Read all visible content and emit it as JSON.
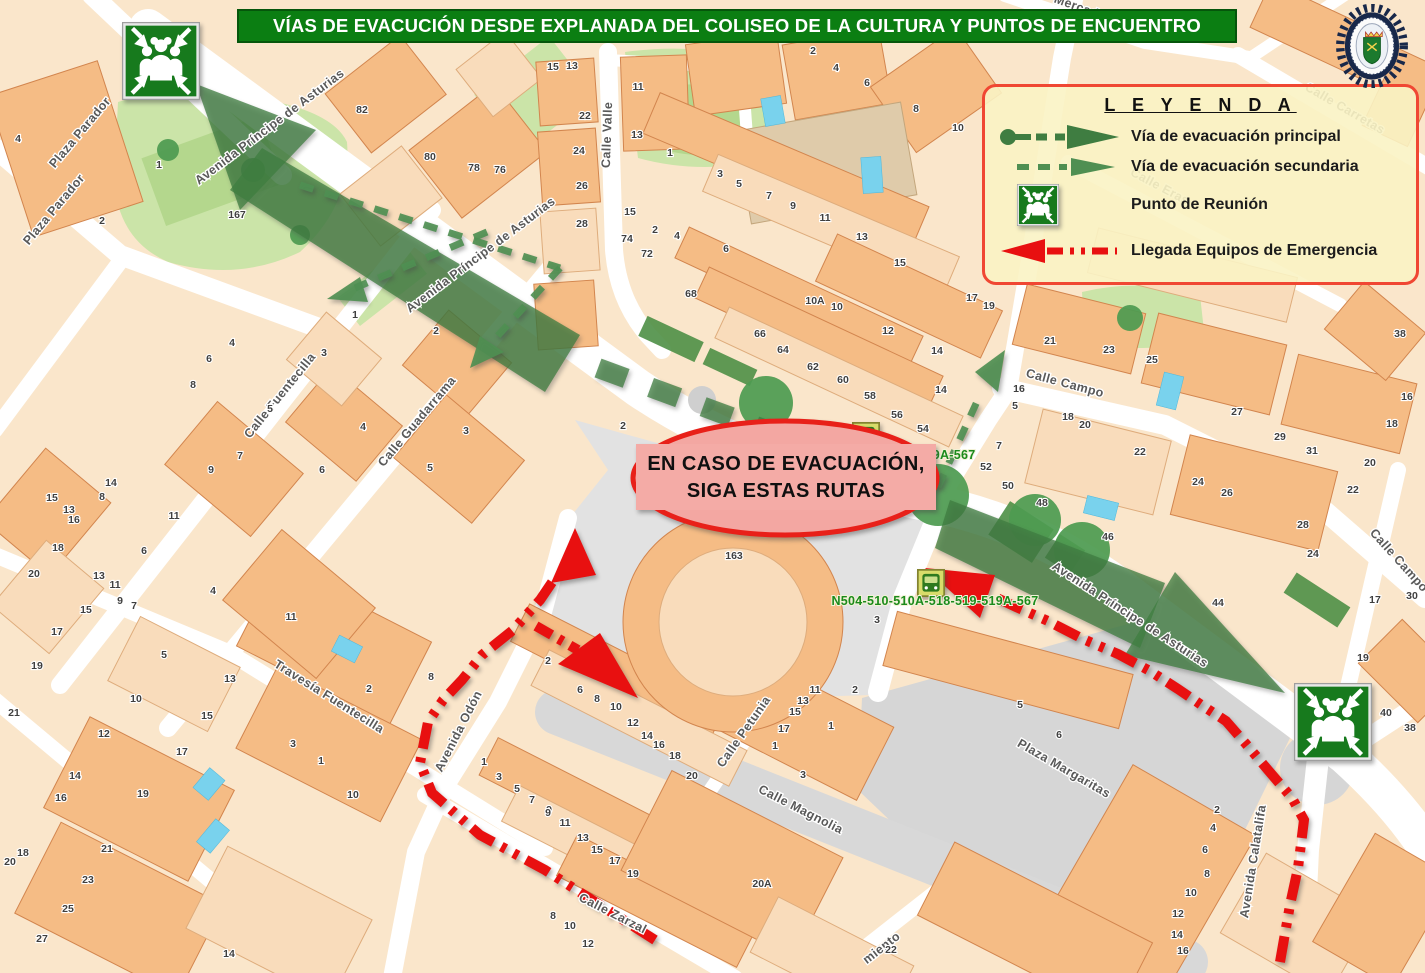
{
  "title": {
    "text": "VÍAS DE EVACUCIÓN DESDE EXPLANADA DEL COLISEO DE LA CULTURA Y PUNTOS DE ENCUENTRO"
  },
  "legend": {
    "title": "L E Y E N D A",
    "items": [
      {
        "id": "principal",
        "icon": "principal-route-arrow-icon",
        "label": "Vía de evacuación principal"
      },
      {
        "id": "secundaria",
        "icon": "secondary-route-arrow-icon",
        "label": "Vía de evacuación secundaria"
      },
      {
        "id": "reunion",
        "icon": "meeting-point-icon",
        "label": "Punto de Reunión"
      },
      {
        "id": "llegada",
        "icon": "emergency-arrival-arrow-icon",
        "label": "Llegada Equipos de Emergencia"
      }
    ]
  },
  "callout": {
    "line1": "EN CASO DE EVACUACIÓN,",
    "line2": "SIGA ESTAS RUTAS"
  },
  "badge": {
    "name": "Policía Local"
  },
  "colors": {
    "banner_green": "#0B7E12",
    "route_principal": "#3F7D41",
    "route_secondary": "#4F8F52",
    "emergency_red": "#E81010",
    "legend_border": "#F04733",
    "legend_bg": "rgba(250,243,196,0.9)"
  },
  "map": {
    "bus_stops": [
      {
        "label": "N504-510-510A-518-519-519A-567",
        "icon_x": 866,
        "icon_y": 436,
        "label_x": 872,
        "label_y": 459
      },
      {
        "label": "N504-510-510A-518-519-519A-567",
        "icon_x": 931,
        "icon_y": 583,
        "label_x": 935,
        "label_y": 605
      }
    ],
    "meeting_points": [
      {
        "x": 161,
        "y": 61
      },
      {
        "x": 1333,
        "y": 722
      }
    ],
    "streets": [
      {
        "name": "Plaza Parador",
        "x": 83,
        "y": 135,
        "angle": -50
      },
      {
        "name": "Plaza Parador",
        "x": 57,
        "y": 212,
        "angle": -50
      },
      {
        "name": "Avenida Príncipe de Asturias",
        "x": 272,
        "y": 130,
        "angle": -37
      },
      {
        "name": "Avenida Príncipe de Asturias",
        "x": 483,
        "y": 258,
        "angle": -37
      },
      {
        "name": "Avenida Príncipe de Asturias",
        "x": 1128,
        "y": 618,
        "angle": 33
      },
      {
        "name": "Calle Valle",
        "x": 611,
        "y": 135,
        "angle": -88
      },
      {
        "name": "Calle Fuentecilla",
        "x": 283,
        "y": 398,
        "angle": -51
      },
      {
        "name": "Calle Guadarrama",
        "x": 420,
        "y": 424,
        "angle": -50
      },
      {
        "name": "Travesía Fuentecilla",
        "x": 327,
        "y": 700,
        "angle": 32
      },
      {
        "name": "Avenida Odón",
        "x": 462,
        "y": 733,
        "angle": -63
      },
      {
        "name": "Calle Petunia",
        "x": 747,
        "y": 734,
        "angle": -55
      },
      {
        "name": "Calle Magnolia",
        "x": 799,
        "y": 813,
        "angle": 27
      },
      {
        "name": "Plaza Margaritas",
        "x": 1062,
        "y": 772,
        "angle": 30
      },
      {
        "name": "Calle Zarzal",
        "x": 611,
        "y": 917,
        "angle": 27
      },
      {
        "name": "Calle Campo",
        "x": 1064,
        "y": 387,
        "angle": 15
      },
      {
        "name": "Calle Campo",
        "x": 1396,
        "y": 563,
        "angle": 48
      },
      {
        "name": "Calle Carretas",
        "x": 1343,
        "y": 112,
        "angle": 30
      },
      {
        "name": "Calle Eras",
        "x": 1158,
        "y": 190,
        "angle": 28
      },
      {
        "name": "Avenida Calatalifa",
        "x": 1257,
        "y": 862,
        "angle": -81
      },
      {
        "name": "Mercad",
        "x": 1075,
        "y": 10,
        "angle": 20
      },
      {
        "name": "miento",
        "x": 884,
        "y": 951,
        "angle": -38
      }
    ],
    "house_numbers": [
      [
        "4",
        18,
        142
      ],
      [
        "2",
        102,
        224
      ],
      [
        "1",
        159,
        168
      ],
      [
        "167",
        237,
        218
      ],
      [
        "82",
        362,
        113
      ],
      [
        "80",
        430,
        160
      ],
      [
        "78",
        474,
        171
      ],
      [
        "76",
        500,
        173
      ],
      [
        "15",
        553,
        70
      ],
      [
        "13",
        572,
        69
      ],
      [
        "22",
        585,
        119
      ],
      [
        "24",
        579,
        154
      ],
      [
        "26",
        582,
        189
      ],
      [
        "28",
        582,
        227
      ],
      [
        "11",
        638,
        90
      ],
      [
        "13",
        637,
        138
      ],
      [
        "1",
        670,
        156
      ],
      [
        "15",
        630,
        215
      ],
      [
        "2",
        655,
        233
      ],
      [
        "4",
        677,
        239
      ],
      [
        "74",
        627,
        242
      ],
      [
        "72",
        647,
        257
      ],
      [
        "6",
        726,
        252
      ],
      [
        "3",
        720,
        177
      ],
      [
        "5",
        739,
        187
      ],
      [
        "7",
        769,
        199
      ],
      [
        "9",
        793,
        209
      ],
      [
        "11",
        825,
        221
      ],
      [
        "13",
        862,
        240
      ],
      [
        "15",
        900,
        266
      ],
      [
        "2",
        813,
        54
      ],
      [
        "4",
        836,
        71
      ],
      [
        "6",
        867,
        86
      ],
      [
        "8",
        916,
        112
      ],
      [
        "10",
        958,
        131
      ],
      [
        "68",
        691,
        297
      ],
      [
        "66",
        760,
        337
      ],
      [
        "64",
        783,
        353
      ],
      [
        "62",
        813,
        370
      ],
      [
        "60",
        843,
        383
      ],
      [
        "58",
        870,
        399
      ],
      [
        "56",
        897,
        418
      ],
      [
        "54",
        923,
        432
      ],
      [
        "10A",
        815,
        304
      ],
      [
        "10",
        837,
        310
      ],
      [
        "12",
        888,
        334
      ],
      [
        "14",
        937,
        354
      ],
      [
        "14",
        941,
        393
      ],
      [
        "17",
        972,
        301
      ],
      [
        "19",
        989,
        309
      ],
      [
        "163",
        734,
        559
      ],
      [
        "2",
        623,
        429
      ],
      [
        "52",
        986,
        470
      ],
      [
        "50",
        1008,
        489
      ],
      [
        "7",
        999,
        449
      ],
      [
        "5",
        1015,
        409
      ],
      [
        "16",
        1019,
        392
      ],
      [
        "21",
        1050,
        344
      ],
      [
        "23",
        1109,
        353
      ],
      [
        "25",
        1152,
        363
      ],
      [
        "27",
        1237,
        415
      ],
      [
        "29",
        1280,
        440
      ],
      [
        "31",
        1312,
        454
      ],
      [
        "38",
        1400,
        337
      ],
      [
        "16",
        1407,
        400
      ],
      [
        "18",
        1392,
        427
      ],
      [
        "20",
        1370,
        466
      ],
      [
        "22",
        1353,
        493
      ],
      [
        "18",
        1068,
        420
      ],
      [
        "20",
        1085,
        428
      ],
      [
        "22",
        1140,
        455
      ],
      [
        "24",
        1198,
        485
      ],
      [
        "26",
        1227,
        496
      ],
      [
        "28",
        1303,
        528
      ],
      [
        "24",
        1313,
        557
      ],
      [
        "48",
        1042,
        506
      ],
      [
        "46",
        1108,
        540
      ],
      [
        "44",
        1218,
        606
      ],
      [
        "17",
        1375,
        603
      ],
      [
        "30",
        1412,
        599
      ],
      [
        "19",
        1363,
        661
      ],
      [
        "40",
        1386,
        716
      ],
      [
        "38",
        1410,
        731
      ],
      [
        "2",
        1217,
        813
      ],
      [
        "4",
        1213,
        831
      ],
      [
        "6",
        1205,
        853
      ],
      [
        "8",
        1207,
        877
      ],
      [
        "10",
        1191,
        896
      ],
      [
        "12",
        1178,
        917
      ],
      [
        "14",
        1177,
        938
      ],
      [
        "16",
        1183,
        954
      ],
      [
        "14",
        111,
        486
      ],
      [
        "8",
        102,
        500
      ],
      [
        "15",
        52,
        501
      ],
      [
        "13",
        69,
        513
      ],
      [
        "16",
        74,
        523
      ],
      [
        "18",
        58,
        551
      ],
      [
        "20",
        34,
        577
      ],
      [
        "11",
        174,
        519
      ],
      [
        "6",
        144,
        554
      ],
      [
        "4",
        213,
        594
      ],
      [
        "13",
        99,
        579
      ],
      [
        "11",
        115,
        588
      ],
      [
        "9",
        120,
        604
      ],
      [
        "7",
        134,
        609
      ],
      [
        "15",
        86,
        613
      ],
      [
        "17",
        57,
        635
      ],
      [
        "5",
        164,
        658
      ],
      [
        "19",
        37,
        669
      ],
      [
        "13",
        230,
        682
      ],
      [
        "15",
        207,
        719
      ],
      [
        "17",
        182,
        755
      ],
      [
        "10",
        136,
        702
      ],
      [
        "12",
        104,
        737
      ],
      [
        "21",
        14,
        716
      ],
      [
        "14",
        75,
        779
      ],
      [
        "16",
        61,
        801
      ],
      [
        "19",
        143,
        797
      ],
      [
        "18",
        23,
        856
      ],
      [
        "20",
        10,
        865
      ],
      [
        "21",
        107,
        852
      ],
      [
        "23",
        88,
        883
      ],
      [
        "25",
        68,
        912
      ],
      [
        "27",
        42,
        942
      ],
      [
        "14",
        229,
        957
      ],
      [
        "4",
        232,
        346
      ],
      [
        "6",
        209,
        362
      ],
      [
        "8",
        193,
        388
      ],
      [
        "1",
        355,
        318
      ],
      [
        "2",
        436,
        334
      ],
      [
        "3",
        324,
        356
      ],
      [
        "5",
        270,
        412
      ],
      [
        "4",
        363,
        430
      ],
      [
        "7",
        240,
        459
      ],
      [
        "9",
        211,
        473
      ],
      [
        "6",
        322,
        473
      ],
      [
        "3",
        466,
        434
      ],
      [
        "5",
        430,
        471
      ],
      [
        "11",
        291,
        620
      ],
      [
        "2",
        369,
        692
      ],
      [
        "8",
        431,
        680
      ],
      [
        "3",
        293,
        747
      ],
      [
        "1",
        321,
        764
      ],
      [
        "10",
        353,
        798
      ],
      [
        "1",
        484,
        765
      ],
      [
        "3",
        499,
        780
      ],
      [
        "5",
        517,
        792
      ],
      [
        "7",
        532,
        803
      ],
      [
        "9",
        549,
        813
      ],
      [
        "2",
        548,
        664
      ],
      [
        "6",
        580,
        693
      ],
      [
        "8",
        597,
        702
      ],
      [
        "10",
        616,
        710
      ],
      [
        "12",
        633,
        726
      ],
      [
        "14",
        647,
        739
      ],
      [
        "16",
        659,
        748
      ],
      [
        "18",
        675,
        759
      ],
      [
        "20",
        692,
        779
      ],
      [
        "9",
        548,
        816
      ],
      [
        "11",
        565,
        826
      ],
      [
        "13",
        583,
        841
      ],
      [
        "15",
        597,
        853
      ],
      [
        "17",
        615,
        864
      ],
      [
        "19",
        633,
        877
      ],
      [
        "8",
        553,
        919
      ],
      [
        "10",
        570,
        929
      ],
      [
        "12",
        588,
        947
      ],
      [
        "20A",
        762,
        887
      ],
      [
        "22",
        891,
        953
      ],
      [
        "13",
        803,
        704
      ],
      [
        "15",
        795,
        715
      ],
      [
        "17",
        784,
        732
      ],
      [
        "11",
        815,
        693
      ],
      [
        "1",
        831,
        729
      ],
      [
        "1",
        775,
        749
      ],
      [
        "3",
        803,
        778
      ],
      [
        "5",
        1020,
        708
      ],
      [
        "6",
        1059,
        738
      ],
      [
        "2",
        855,
        693
      ],
      [
        "3",
        877,
        623
      ]
    ]
  }
}
